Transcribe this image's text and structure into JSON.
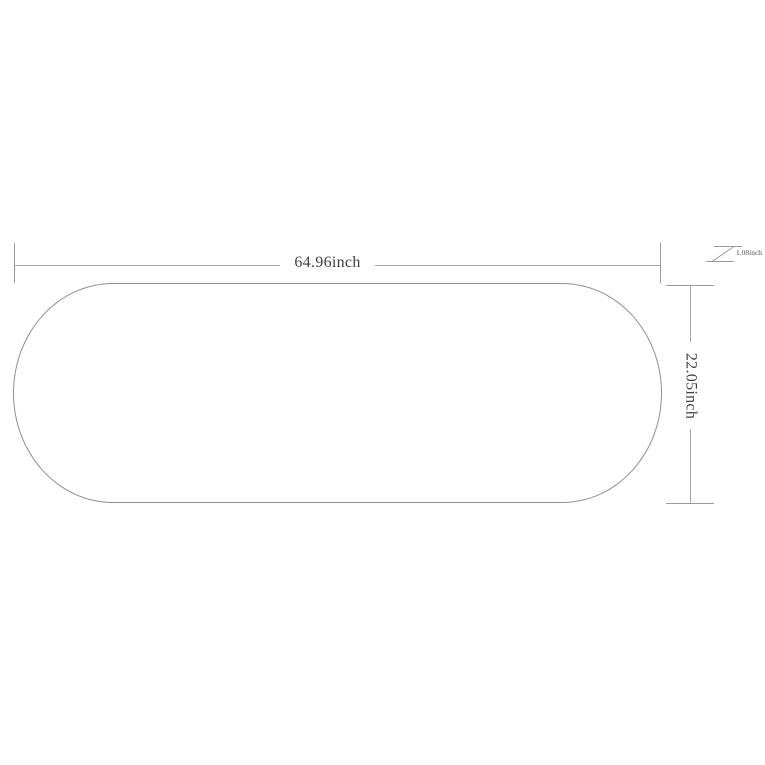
{
  "diagram": {
    "type": "product-dimension-diagram",
    "shape": "rounded-oval-tabletop",
    "colors": {
      "background": "#ffffff",
      "outline": "#8f8f8f",
      "dimension_lines": "#a6a6a6",
      "text": "#3f3f3f"
    },
    "width_dimension": {
      "label": "64.96inch",
      "value": 64.96,
      "unit": "inch"
    },
    "height_dimension": {
      "label": "22.05inch",
      "value": 22.05,
      "unit": "inch"
    },
    "thickness_dimension": {
      "label": "1.08inch",
      "value": 1.08,
      "unit": "inch"
    }
  }
}
